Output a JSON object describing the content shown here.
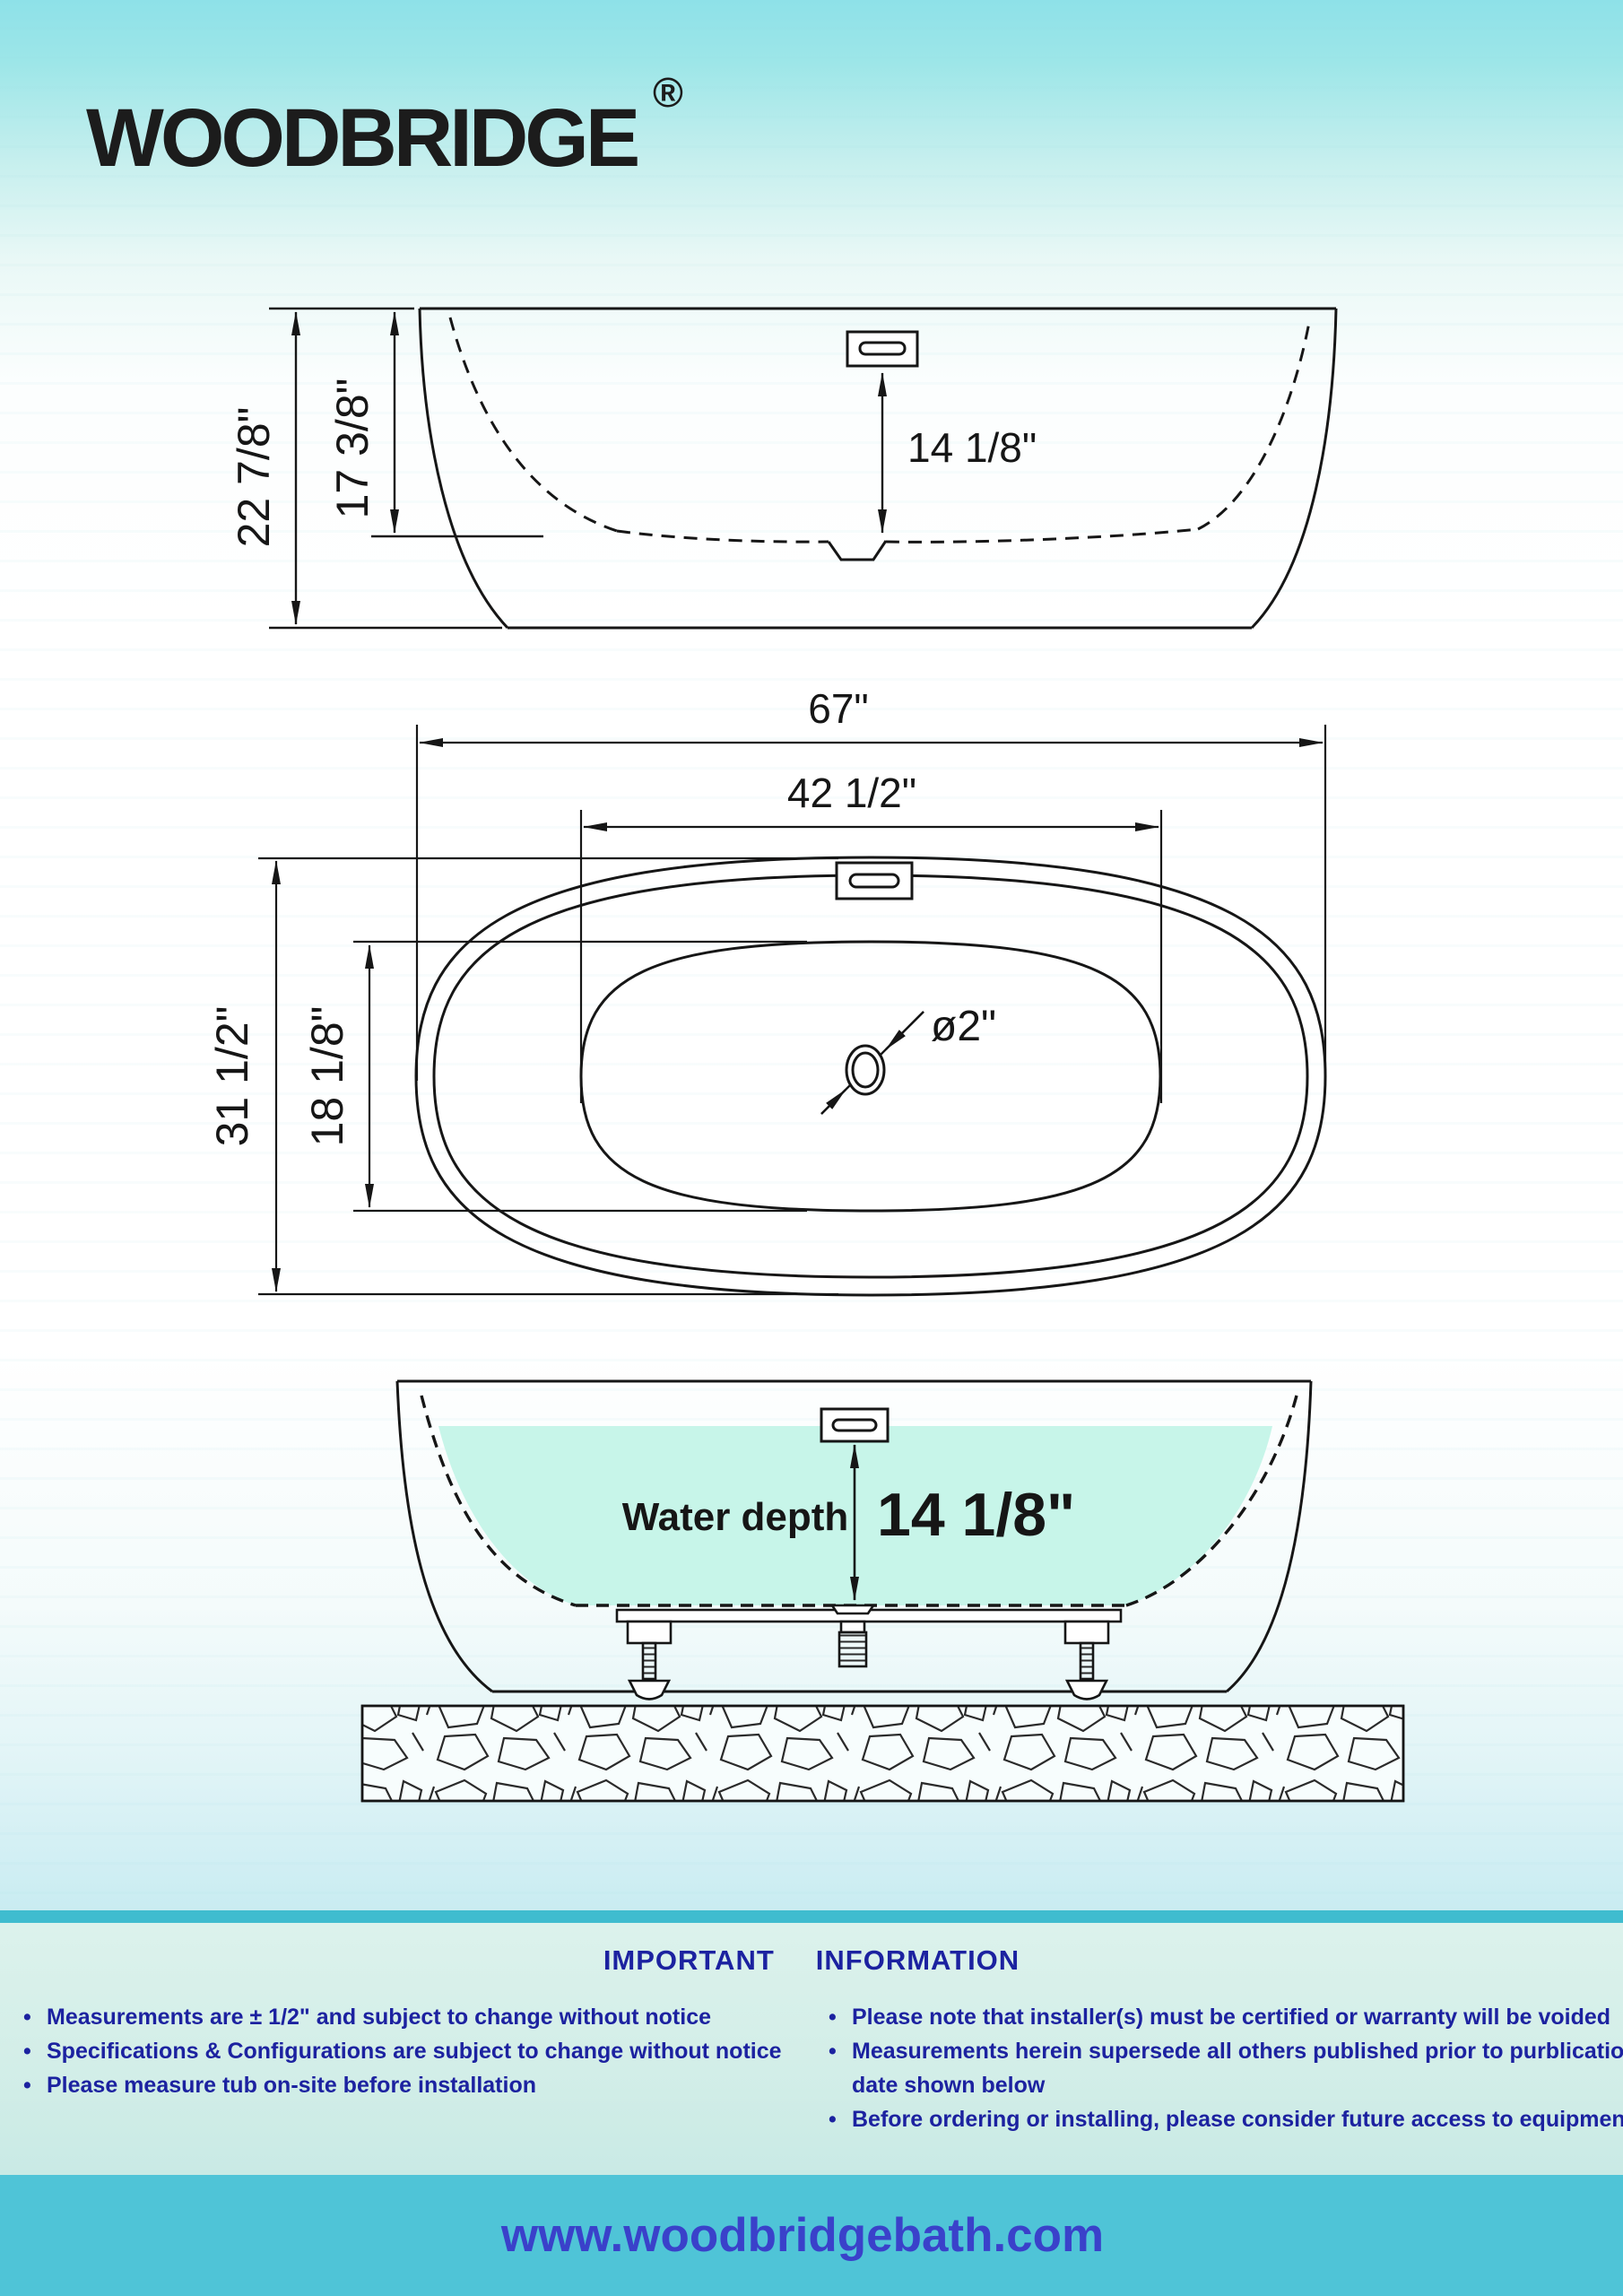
{
  "brand": {
    "logo_text": "WOODBRIDGE",
    "registered_mark": "®"
  },
  "diagrams": {
    "side_view": {
      "overall_height": "22 7/8\"",
      "interior_height": "17 3/8\"",
      "rim_to_floor_depth": "14 1/8\""
    },
    "top_view": {
      "overall_length": "67\"",
      "interior_length": "42 1/2\"",
      "overall_width": "31 1/2\"",
      "interior_width": "18 1/8\"",
      "drain_diameter": "ø2\""
    },
    "section_view": {
      "water_depth_label": "Water depth",
      "water_depth_value": "14 1/8\""
    }
  },
  "info": {
    "title_left": "IMPORTANT",
    "title_right": "INFORMATION",
    "bullet_char": "•",
    "left_bullets": [
      "Measurements are ± 1/2\" and subject to change without notice",
      "Specifications & Configurations are subject to change without notice",
      "Please measure tub on-site before installation"
    ],
    "right_bullets": [
      "Please note that installer(s) must be certified or warranty will be voided",
      "Measurements herein supersede all others published prior to purblication",
      "Before ordering or installing, please consider future access to equipment"
    ],
    "right_bullet_continuation": "date shown below"
  },
  "footer": {
    "website": "www.woodbridgebath.com"
  },
  "colors": {
    "water_fill": "#c7f5e9",
    "accent_band": "#3fbccf",
    "footer_bar": "#4fc4d7",
    "info_text": "#1c22a0",
    "water_label_text": "#1b22b4",
    "website_text": "#3a41ca"
  }
}
